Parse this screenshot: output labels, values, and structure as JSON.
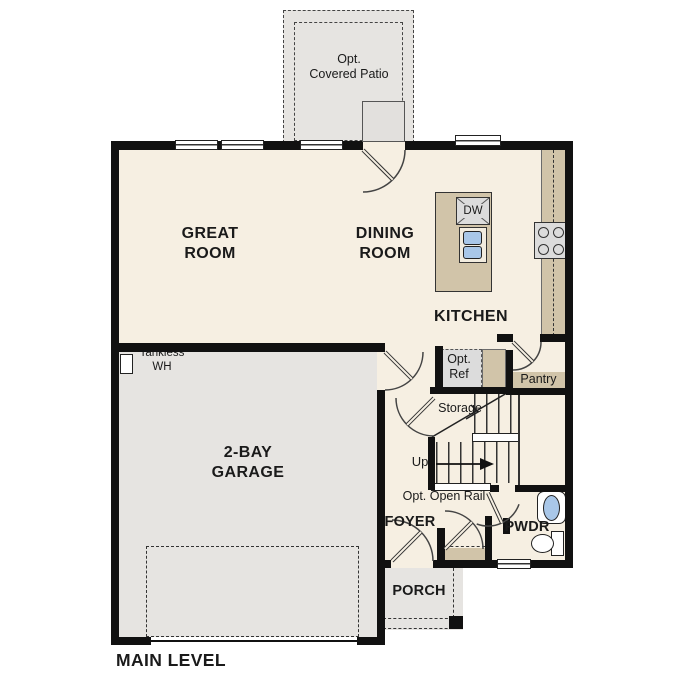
{
  "plan_title": "MAIN LEVEL",
  "rooms": {
    "patio": {
      "label": "Opt.\nCovered Patio"
    },
    "great_room": {
      "label": "GREAT\nROOM"
    },
    "dining_room": {
      "label": "DINING\nROOM"
    },
    "kitchen": {
      "label": "KITCHEN"
    },
    "garage": {
      "label": "2-BAY\nGARAGE"
    },
    "foyer": {
      "label": "FOYER"
    },
    "powder": {
      "label": "PWDR"
    },
    "porch": {
      "label": "PORCH"
    },
    "pantry": {
      "label": "Pantry"
    },
    "storage": {
      "label": "Storage"
    }
  },
  "annotations": {
    "tankless_wh": "Tankless\nWH",
    "opt_ref": "Opt.\nRef",
    "up": "Up",
    "opt_open_rail": "Opt. Open Rail",
    "dishwasher": "DW"
  },
  "colors": {
    "wall": "#111111",
    "floor_cream": "#f6efe2",
    "surface_gray": "#e6e4e1",
    "counter_tan": "#d1c4a9",
    "appliance_gray": "#dcdcdc",
    "sink_blue": "#a9c7e8"
  }
}
